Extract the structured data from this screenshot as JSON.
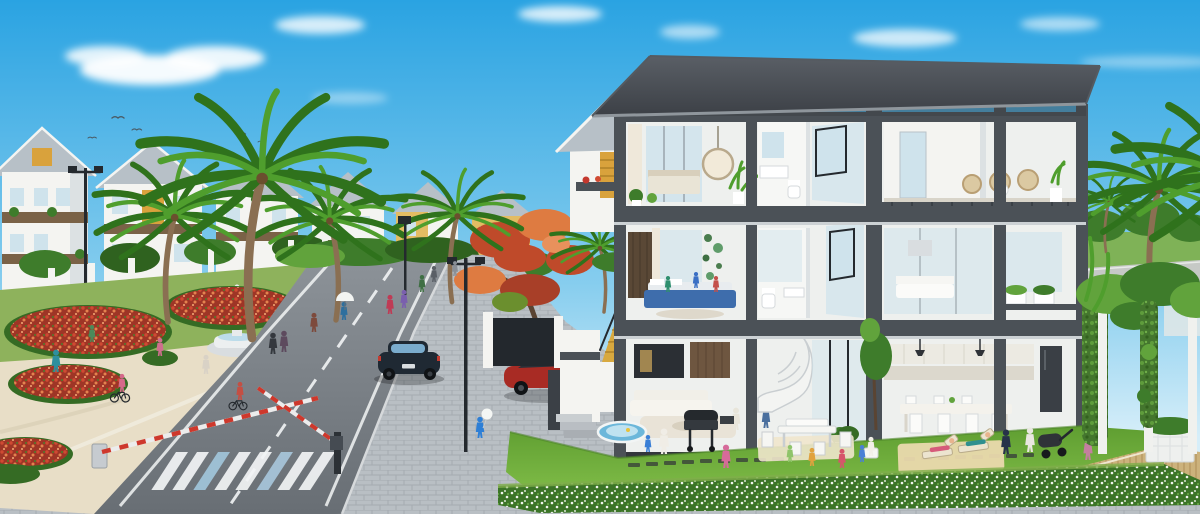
{
  "meta": {
    "type": "architectural-visualization",
    "description": "Sunny 3D render of a villa neighborhood: palm-lined boulevard with flower beds, fountain, pedestrians and cyclists on the left; barrier gates and a zebra crossing on the curving road; a three-storey cut-away show villa on the right revealing furnished interiors, with families relaxing on the front lawn."
  },
  "palette": {
    "sky_top": "#2aa3e2",
    "sky_mid": "#86cdee",
    "sky_horizon": "#d6eef9",
    "cloud": "#ffffff",
    "roof_dark": "#45494f",
    "roof_light": "#b7c0c7",
    "frame": "#4b5157",
    "wall_white": "#f4f4f1",
    "wall_shade": "#dce1e3",
    "interior": "#eef0ee",
    "glass": "#cfe3ec",
    "glass_dark": "#94aebc",
    "curtain": "#efe8da",
    "accent_gold": "#d9a23c",
    "stair_gold": "#d8a93f",
    "wood": "#7a6247",
    "trunk": "#8a6f52",
    "palm_green": "#4f9e2d",
    "palm_dark": "#2f721c",
    "foliage": "#3e7c2b",
    "foliage_light": "#61a33c",
    "flame_red": "#bf4a2a",
    "flame_orange": "#de7b41",
    "grass": "#79b840",
    "grass_dark": "#55922c",
    "hedge_dark": "#356b24",
    "park_green": "#8eb25c",
    "flower_base": "#9e3526",
    "flower_red": "#d04a32",
    "flower_orange": "#e4824e",
    "road": "#7b8288",
    "road_far": "#8d9399",
    "marking": "#f2f4f5",
    "paver": "#b9bfc4",
    "paver_line": "#a5abb1",
    "sand": "#e8dec7",
    "walk": "#d6cfbd",
    "curb": "#d6d9db",
    "barrier_red": "#ce382c",
    "metal": "#24292e",
    "car_dark": "#1f2933",
    "car_glass": "#7fb3d6",
    "car_red": "#a82b24",
    "deck": "#ccb27c",
    "mat": "#ead9ad",
    "pool": "#6cb7da"
  },
  "scene": {
    "sky": [
      "clear blue sky",
      "soft white clouds",
      "small flying birds"
    ],
    "left": [
      "row of white villas with grey gable roofs and wooden balconies",
      "dark perimeter fence with white piers",
      "tall fan palms",
      "flame tree with orange foliage",
      "white tiered fountain",
      "flower beds of red and orange blooms edged with hedges",
      "sandy plaza with children on bicycles",
      "pedestrians strolling"
    ],
    "road": [
      "curving asphalt boulevard",
      "white edge lines and dashed centre line",
      "zebra crossing",
      "red-and-white barrier gate arms",
      "street lamps",
      "dark sedan driving",
      "red sports car parked by gate wall"
    ],
    "building": [
      "three-storey cut-away villa with dark structural frame",
      "dark grey hipped roof",
      "top floor bedroom, bathroom and wicker-chair terrace",
      "middle floor kids bedroom with blue bed, bathroom, white lounge and planter balcony",
      "ground floor living room with white sofa and spiral staircase",
      "kitchen and family dining room",
      "golden timber side stair",
      "neighbouring gable house with flower balcony"
    ],
    "lawn": [
      "bright front lawn",
      "barbecue grill",
      "white picnic table and chairs",
      "sun loungers on straw mat",
      "baby stroller",
      "children playing",
      "small paddling pool",
      "stepping stones",
      "flowering white hedge",
      "vine-covered pergola with timber deck",
      "paver promenade"
    ]
  }
}
